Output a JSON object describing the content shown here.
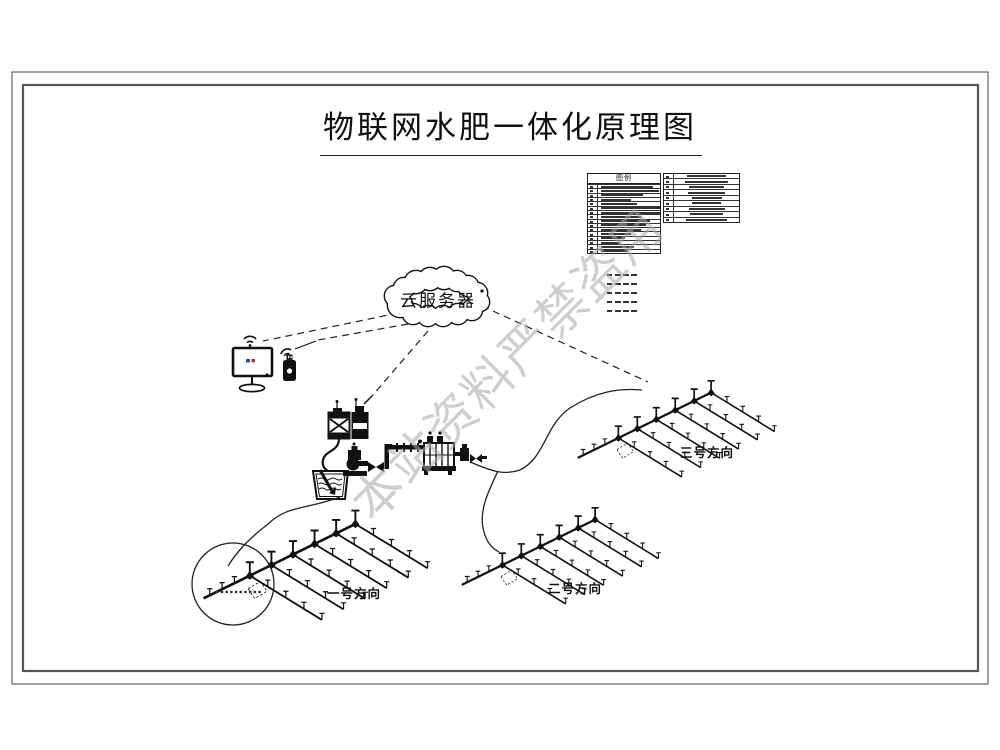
{
  "page": {
    "title": "物联网水肥一体化原理图"
  },
  "legend": {
    "title": "图例",
    "left_row_count": 16,
    "right_row_count": 9,
    "line_sample_count": 5
  },
  "cloud": {
    "label": "云服务器"
  },
  "fields": [
    {
      "label": "一号方向"
    },
    {
      "label": "二号方向"
    },
    {
      "label": "三号方向"
    }
  ],
  "watermark": {
    "text": "本站资料严禁盗用",
    "color": "#a9a9a9"
  },
  "colors": {
    "ink": "#111111",
    "frame": "#555555",
    "background": "#ffffff"
  },
  "icons": {
    "cloud": "cloud-server-icon",
    "monitor": "monitor-icon",
    "wifi": "wifi-icon",
    "phone": "mobile-device-icon"
  }
}
